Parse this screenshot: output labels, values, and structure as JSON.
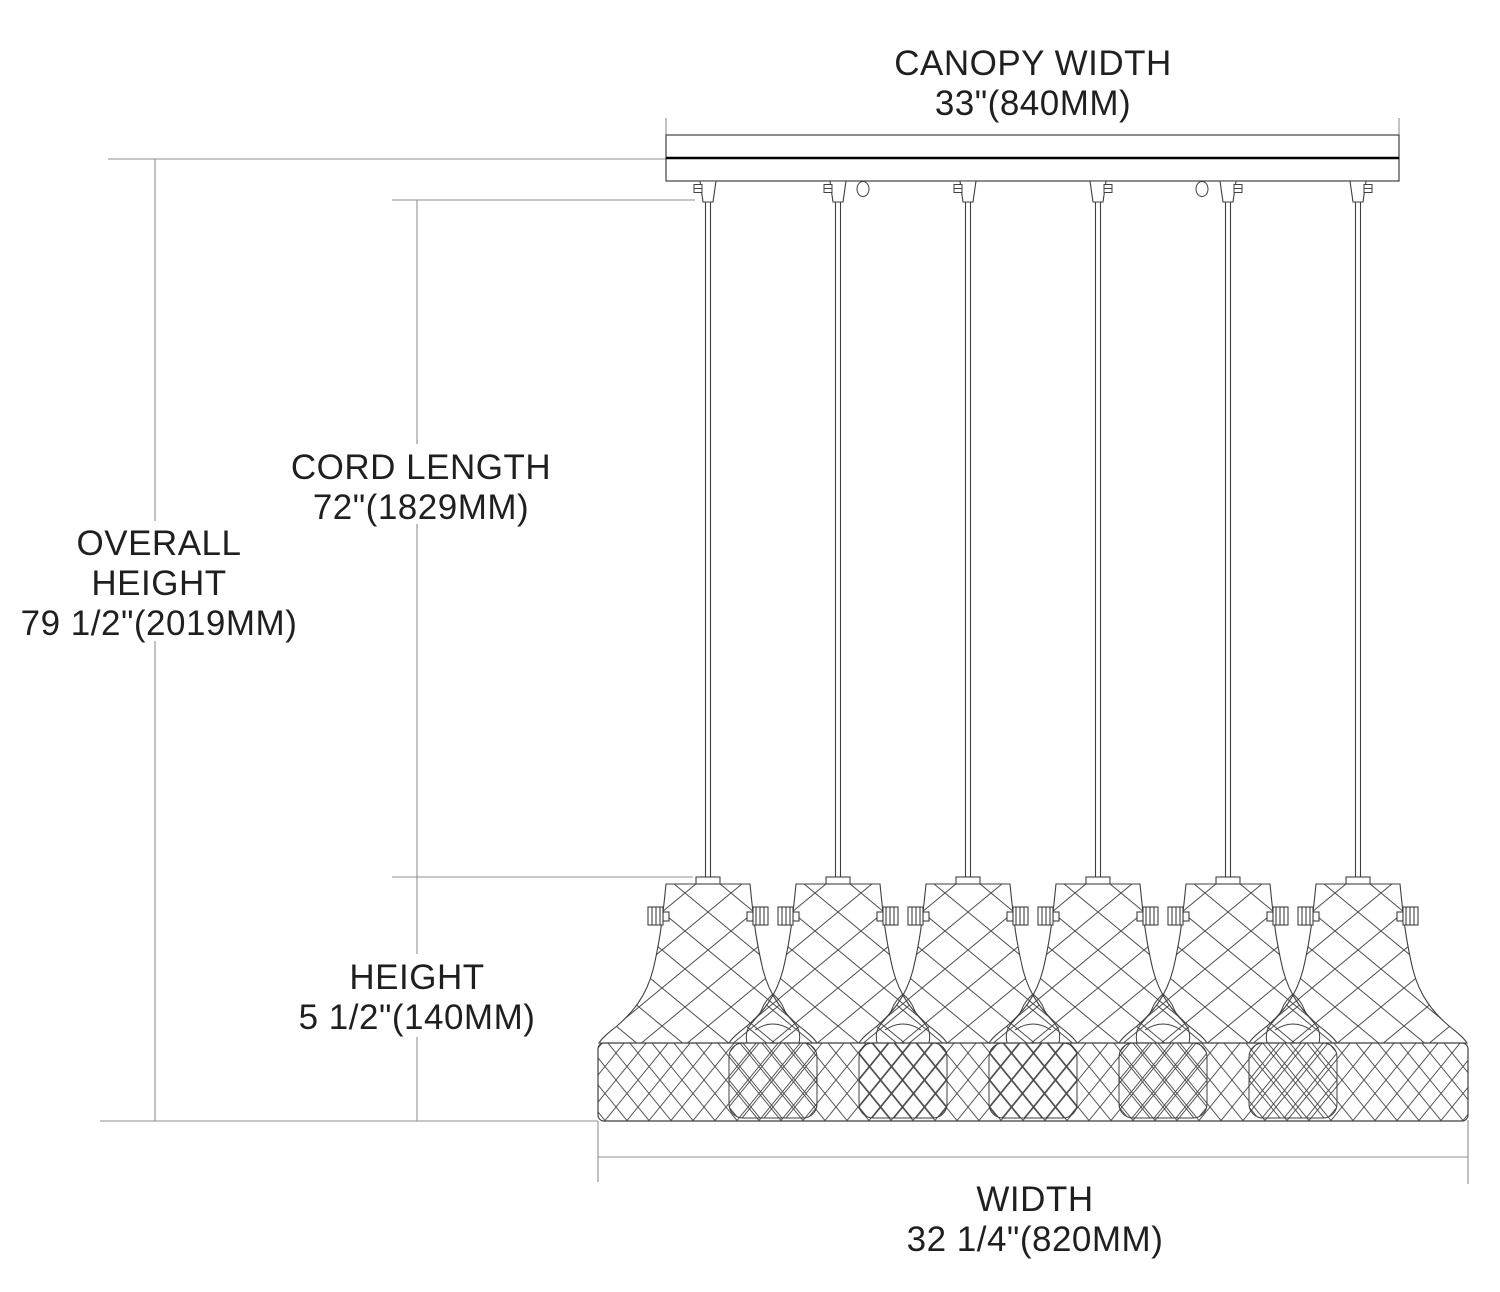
{
  "diagram_title": "6-light linear pendant fixture dimension drawing",
  "fixture": {
    "pendant_count": 6,
    "canopy_mounting_loops": 2
  },
  "labels": {
    "canopy_width": {
      "line1": "CANOPY WIDTH",
      "line2": "33\"(840MM)"
    },
    "cord_length": {
      "line1": "CORD LENGTH",
      "line2": "72\"(1829MM)"
    },
    "overall_height": {
      "line1": "OVERALL",
      "line2": "HEIGHT",
      "line3": "79 1/2\"(2019MM)"
    },
    "height": {
      "line1": "HEIGHT",
      "line2": "5 1/2\"(140MM)"
    },
    "width": {
      "line1": "WIDTH",
      "line2": "32 1/4\"(820MM)"
    }
  },
  "colors": {
    "background": "#ffffff",
    "drawing_line": "#3f3f3f",
    "hatch_line": "#4a4a4a",
    "dimension_line": "#8f8f8f",
    "bold_line": "#000000",
    "text": "#1f1f1f"
  }
}
